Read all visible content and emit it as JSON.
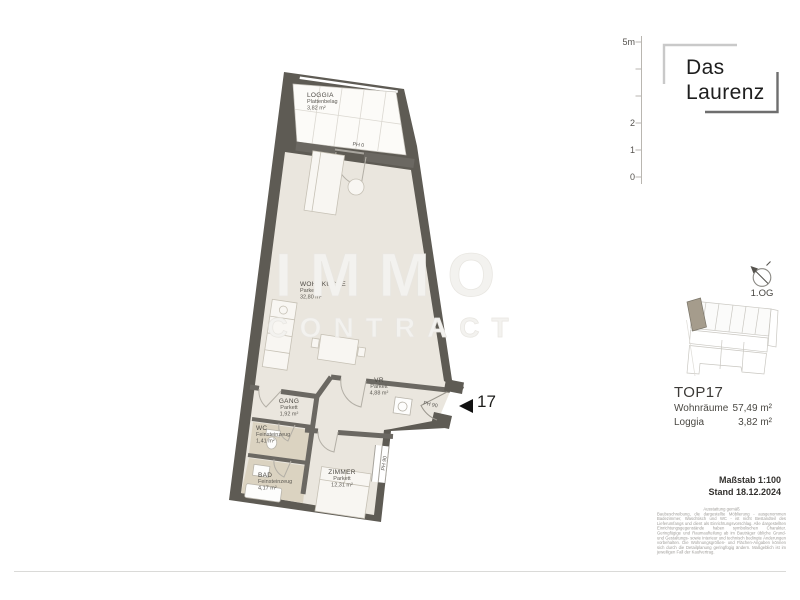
{
  "branding": {
    "line1": "Das",
    "line2": "Laurenz"
  },
  "scale_bar": {
    "labels": [
      "5m",
      "2",
      "1",
      "0"
    ]
  },
  "compass": {
    "label": "1.OG"
  },
  "watermark": {
    "line1": "IMMO",
    "line2": "CONTRACT"
  },
  "rooms": [
    {
      "name": "LOGGIA",
      "floor": "Plattenbelag",
      "area": "3,82 m²"
    },
    {
      "name": "WOHNKÜCHE",
      "floor": "Parkett",
      "area": "32,80 m²"
    },
    {
      "name": "VR",
      "floor": "Parkett",
      "area": "4,88 m²"
    },
    {
      "name": "GANG",
      "floor": "Parkett",
      "area": "1,92 m²"
    },
    {
      "name": "WC",
      "floor": "Feinsteinzeug",
      "area": "1,41 m²"
    },
    {
      "name": "BAD",
      "floor": "Feinsteinzeug",
      "area": "4,17 m²"
    },
    {
      "name": "ZIMMER",
      "floor": "Parkett",
      "area": "12,31 m²"
    }
  ],
  "door_labels": {
    "loggia": "PH 0",
    "entrance": "PH 90",
    "window": "PH 90"
  },
  "entrance": {
    "number": "17"
  },
  "unit_info": {
    "title": "TOP17",
    "rows": [
      {
        "label": "Wohnräume",
        "value": "57,49 m²"
      },
      {
        "label": "Loggia",
        "value": "3,82 m²"
      }
    ]
  },
  "meta": {
    "scale": "Maßstab 1:100",
    "date": "Stand 18.12.2024"
  },
  "disclaimer": {
    "title": "Ausstattung gemäß",
    "body": "Baubeschreibung, die dargestellte Möblierung - ausgenommen Badezimmer, Waschtisch und WC - ist nicht Bestandteil des Lieferumfangs und dient als Einrichtungsvorschlag. Alle dargestellten Einrichtungsgegenstände haben symbolischen Charakter. Geringfügige und Raumaufteilung ab im Bauträger übliche Grund- und Gestaltungs- sowie Interieur und technisch bedingte Änderungen vorbehalten. Die Wohnungsgrößen- und Flächen-Angaben können sich durch die Detailplanung geringfügig ändern. Maßgeblich ist im jeweiligen Fall der Kaufvertrag."
  },
  "colors": {
    "wall": "#5e5b54",
    "parkett": "#eae6de",
    "wet_floor": "#dbd3c1",
    "unit_highlight": "#a59c8c"
  }
}
